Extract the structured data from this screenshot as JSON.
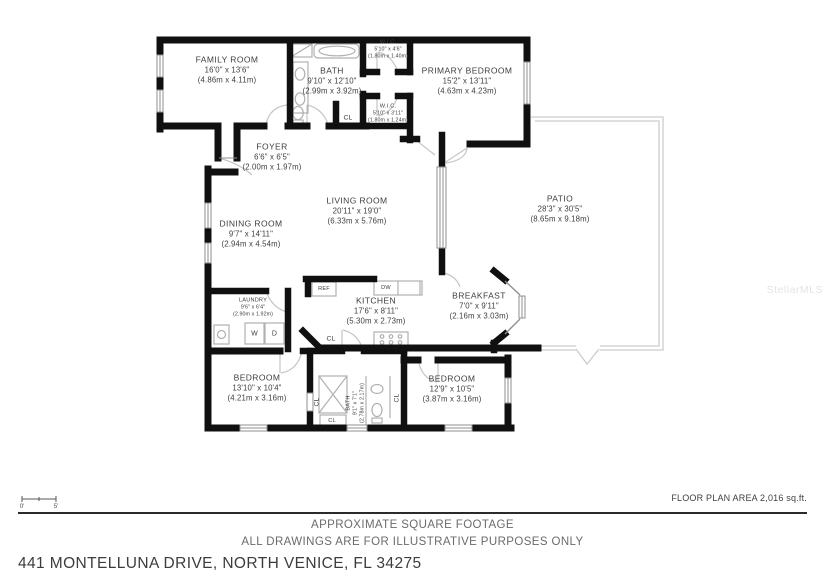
{
  "meta": {
    "watermark": "StellarMLS"
  },
  "rooms": {
    "family_room": {
      "name": "FAMILY ROOM",
      "imperial": "16'0\" x 13'6\"",
      "metric": "(4.86m x 4.11m)"
    },
    "bath": {
      "name": "BATH",
      "imperial": "9'10\" x 12'10\"",
      "metric": "(2.99m x 3.92m)"
    },
    "wic_top": {
      "name": "W.I.C.",
      "imperial": "5'10\" x 4'6\"",
      "metric": "(1.80m x 1.40m)"
    },
    "wic_bottom": {
      "name": "W.I.C.",
      "imperial": "5'10\" x 3'11\"",
      "metric": "(1.80m x 1.24m)"
    },
    "primary_bedroom": {
      "name": "PRIMARY BEDROOM",
      "imperial": "15'2\" x 13'11\"",
      "metric": "(4.63m x 4.23m)"
    },
    "foyer": {
      "name": "FOYER",
      "imperial": "6'6\" x 6'5\"",
      "metric": "(2.00m x 1.97m)"
    },
    "living_room": {
      "name": "LIVING ROOM",
      "imperial": "20'11\" x 19'0\"",
      "metric": "(6.33m x 5.76m)"
    },
    "dining_room": {
      "name": "DINING ROOM",
      "imperial": "9'7\" x 14'11\"",
      "metric": "(2.94m x 4.54m)"
    },
    "patio": {
      "name": "PATIO",
      "imperial": "28'3\" x 30'5\"",
      "metric": "(8.65m x 9.18m)"
    },
    "kitchen": {
      "name": "KITCHEN",
      "imperial": "17'6\" x 8'11\"",
      "metric": "(5.30m x 2.73m)"
    },
    "breakfast": {
      "name": "BREAKFAST",
      "imperial": "7'0\" x 9'11\"",
      "metric": "(2.16m x 3.03m)"
    },
    "laundry": {
      "name": "LAUNDRY",
      "imperial": "9'6\" x 6'4\"",
      "metric": "(2.90m x 1.92m)"
    },
    "bedroom_left": {
      "name": "BEDROOM",
      "imperial": "13'10\" x 10'4\"",
      "metric": "(4.21m x 3.16m)"
    },
    "bedroom_right": {
      "name": "BEDROOM",
      "imperial": "12'9\" x 10'5\"",
      "metric": "(3.87m x 3.16m)"
    },
    "bath_lower": {
      "name": "BATH",
      "imperial": "9'1\" x 7'1\"",
      "metric": "(2.78m x 2.17m)"
    }
  },
  "labels": {
    "cl": "CL",
    "washer": "W",
    "dryer": "D",
    "fridge": "REF",
    "dishwasher": "DW"
  },
  "scale": {
    "zero": "0'",
    "five": "5'"
  },
  "footer": {
    "area_note": "FLOOR PLAN AREA 2,016 sq.ft.",
    "disclaimer_line1": "APPROXIMATE SQUARE FOOTAGE",
    "disclaimer_line2": "ALL DRAWINGS ARE FOR ILLUSTRATIVE PURPOSES ONLY",
    "address": "441 MONTELLUNA DRIVE, NORTH VENICE, FL 34275"
  }
}
